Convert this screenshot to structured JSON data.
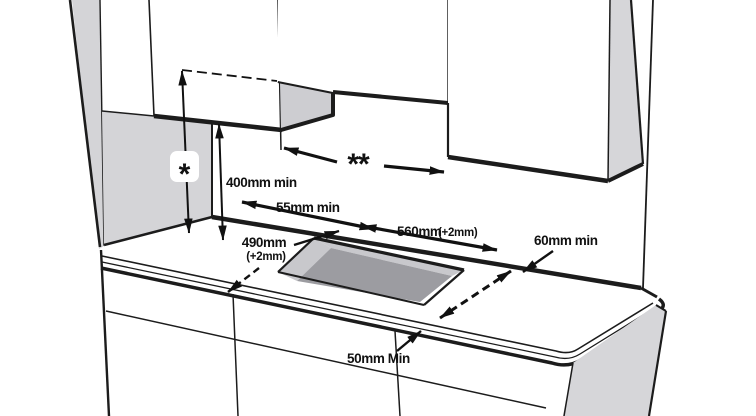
{
  "diagram": {
    "type": "installation-clearance-diagram",
    "subject": "Built-in hob worktop cutout and minimum clearances between wall cabinets, hood space and worktop",
    "markers": {
      "star": "*",
      "double_star": "**"
    },
    "dimensions": {
      "under_cabinet_clearance": "400mm min",
      "rear_wall_gap": "55mm min",
      "cutout_depth": "490mm",
      "cutout_depth_tolerance": "(+2mm)",
      "cutout_width": "560mm",
      "cutout_width_tolerance": "(+2mm)",
      "rear_clearance": "60mm min",
      "side_clearance": "50mm Min"
    },
    "colors": {
      "line": "#1c1c1c",
      "dimension": "#111111",
      "wall_gray": "#d4d4d7",
      "recess_gray": "#cdcdd1",
      "cutout_wall_gray": "#c8c8cc",
      "cutout_floor_gray": "#9c9ca1",
      "panel_gray": "#d6d6d9",
      "background": "#ffffff"
    }
  }
}
